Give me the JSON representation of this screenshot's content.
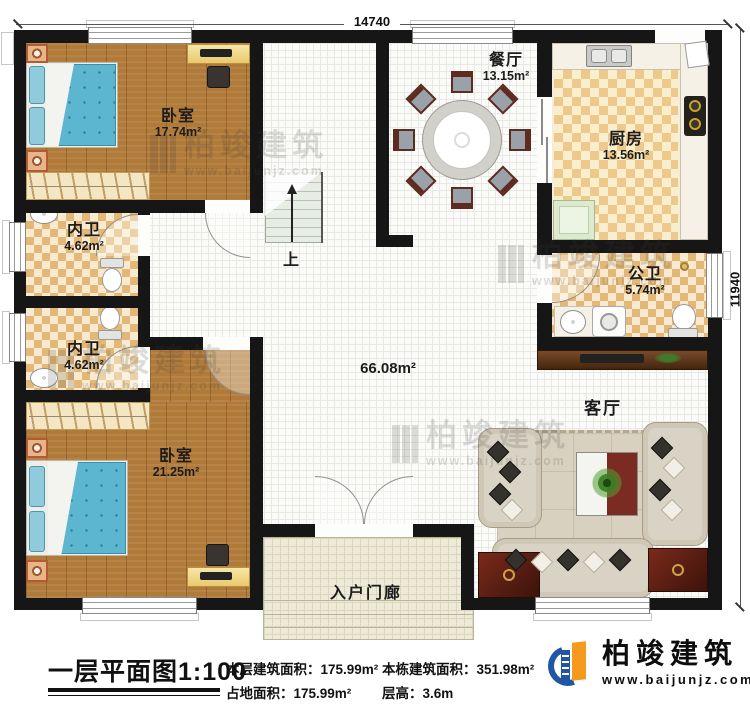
{
  "dimensions": {
    "width_label": "14740",
    "height_label": "11940"
  },
  "rooms": {
    "bedroom_top": {
      "name": "卧室",
      "area": "17.74m²"
    },
    "inner_bath_top": {
      "name": "内卫",
      "area": "4.62m²"
    },
    "inner_bath_bottom": {
      "name": "内卫",
      "area": "4.62m²"
    },
    "bedroom_bottom": {
      "name": "卧室",
      "area": "21.25m²"
    },
    "dining": {
      "name": "餐厅",
      "area": "13.15m²"
    },
    "kitchen": {
      "name": "厨房",
      "area": "13.56m²"
    },
    "public_bath": {
      "name": "公卫",
      "area": "5.74m²"
    },
    "living": {
      "name": "客厅"
    },
    "hall": {
      "area": "66.08m²"
    },
    "porch": {
      "name": "入户门廊"
    },
    "stairs": {
      "up_label": "上"
    }
  },
  "footer": {
    "title": "一层平面图1:100",
    "stats": [
      {
        "label": "本层建筑面积：",
        "value": "175.99m²"
      },
      {
        "label": "占地面积：",
        "value": "175.99m²"
      },
      {
        "label": "本栋建筑面积：",
        "value": "351.98m²"
      },
      {
        "label": "层高：",
        "value": "3.6m"
      }
    ]
  },
  "brand": {
    "name": "柏竣建筑",
    "website": "www.baijunjz.com",
    "blue": "#2156a5",
    "orange": "#f59a1e"
  },
  "watermark": {
    "name": "柏竣建筑",
    "website": "www.baijunjz.com"
  }
}
